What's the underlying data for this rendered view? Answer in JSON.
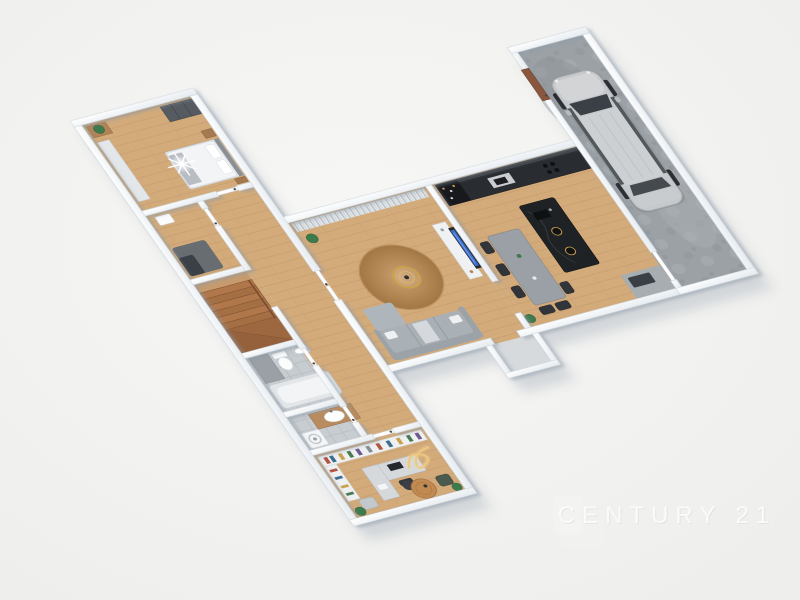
{
  "scene": {
    "type": "3d-floor-plan-render",
    "view": "top-down dollhouse perspective",
    "background_color": "#f3f3f1",
    "wall_color": "#ffffff",
    "wall_shade_color": "#e6ebf0"
  },
  "watermark": {
    "text": "CENTURY 21",
    "color": "#ffffff",
    "opacity": 0.8
  },
  "palette": {
    "wood_floor": "#d3ab7a",
    "wood_plank_line": "#c2966a",
    "stair_wood": "#ad744a",
    "tile_gray": "#c7ccd0",
    "concrete_gray": "#9ba1a5",
    "sofa_gray": "#a9b0b6",
    "rug_brown": "#c89a6b",
    "gold_accent": "#c9a24f",
    "tv_screen_blue": "#3b6fd0",
    "kitchen_dark": "#292c30",
    "island_black_marble": "#1f2225",
    "car_body": "#c6c9cb",
    "entry_door_brown": "#8a573e",
    "light_flare": "#ffffff"
  },
  "rooms": [
    {
      "id": "bedroom",
      "name": "Bedroom",
      "floor": "wood",
      "furniture": [
        "double bed with white duvet",
        "gray throw blanket",
        "dark gray wardrobe",
        "light closet",
        "wood dresser with plant",
        "nightstand",
        "starburst light flare"
      ]
    },
    {
      "id": "utility",
      "name": "Utility room",
      "floor": "wood",
      "furniture": [
        "wall water heater",
        "dark cabinet",
        "dark gray mat"
      ]
    },
    {
      "id": "hallway",
      "name": "Hallway",
      "floor": "wood",
      "furniture": [
        "white interior doors with dark handles"
      ]
    },
    {
      "id": "staircase",
      "name": "Staircase",
      "floor": "wood",
      "furniture": [
        "winding wooden stairs",
        "handrail"
      ]
    },
    {
      "id": "bathroom",
      "name": "Bathroom",
      "floor": "gray tile",
      "furniture": [
        "bathtub",
        "shower corner",
        "toilet",
        "wall basin"
      ]
    },
    {
      "id": "wc",
      "name": "WC / Laundry",
      "floor": "gray tile",
      "furniture": [
        "wood vanity with basin",
        "washing machine"
      ]
    },
    {
      "id": "office",
      "name": "Home office",
      "floor": "wood",
      "furniture": [
        "bookshelves with colorful books",
        "desk with monitor",
        "office chair",
        "round wood rug",
        "lounge chairs",
        "potted plants",
        "gold light scribble flare"
      ]
    },
    {
      "id": "living",
      "name": "Living room",
      "floor": "wood",
      "furniture": [
        "gray curtains",
        "wall TV with blue screen",
        "media console",
        "gray sofa with white pillows",
        "round brown rug",
        "gold ring coffee table",
        "plant"
      ]
    },
    {
      "id": "kitchen",
      "name": "Kitchen / Dining",
      "floor": "wood",
      "furniture": [
        "dark counter run with sink and hob",
        "tall bottle cabinet",
        "black marble island with faucet",
        "two pendant lamps",
        "gray dining table",
        "six dark chairs",
        "utility closet"
      ]
    },
    {
      "id": "garage",
      "name": "Garage",
      "floor": "concrete",
      "furniture": [
        "parked SUV",
        "brown entry door"
      ]
    },
    {
      "id": "porch",
      "name": "Entry porch",
      "floor": "gray",
      "furniture": []
    }
  ]
}
